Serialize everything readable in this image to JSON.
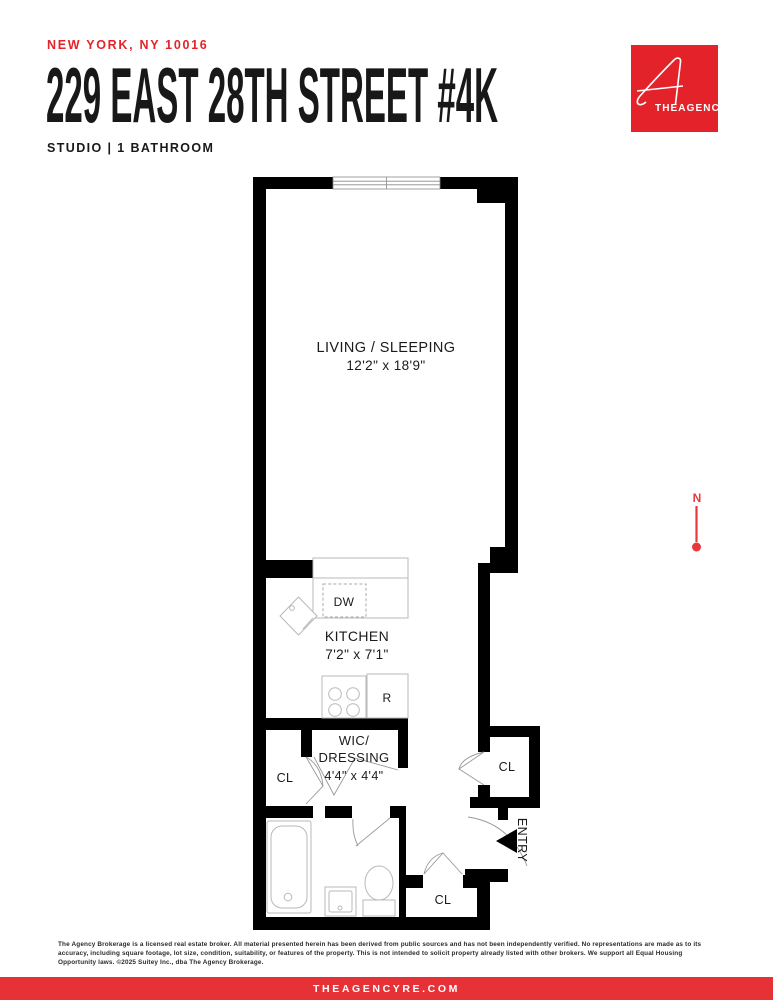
{
  "header": {
    "location": "NEW YORK, NY 10016",
    "title": "229 EAST 28TH STREET #4K",
    "subtitle": "STUDIO | 1 BATHROOM"
  },
  "logo": {
    "brand": "THEAGENCY",
    "color": "#e32329"
  },
  "plan": {
    "living": {
      "name": "LIVING / SLEEPING",
      "dims": "12'2\" x 18'9\""
    },
    "kitchen": {
      "name": "KITCHEN",
      "dims": "7'2\" x 7'1\""
    },
    "wic": {
      "line1": "WIC/",
      "line2": "DRESSING",
      "dims": "4'4\" x 4'4\""
    },
    "closet_left": {
      "label": "CL"
    },
    "closet_right": {
      "label": "CL"
    },
    "closet_bottom": {
      "label": "CL"
    },
    "entry": {
      "label": "ENTRY"
    },
    "appliances": {
      "dishwasher": "DW",
      "refrigerator": "R"
    },
    "compass": {
      "label": "N"
    }
  },
  "footer": {
    "disclaimer": "The Agency Brokerage is a licensed real estate broker. All material presented herein has been derived from public sources and has not been independently verified. No representations are made as to its accuracy, including square footage, lot size, condition, suitability, or features of the property. This is not intended to solicit property already listed with other brokers. We support all Equal Housing Opportunity laws. ©2025 Suitey Inc., dba The Agency Brokerage.",
    "website": "THEAGENCYRE.COM"
  }
}
